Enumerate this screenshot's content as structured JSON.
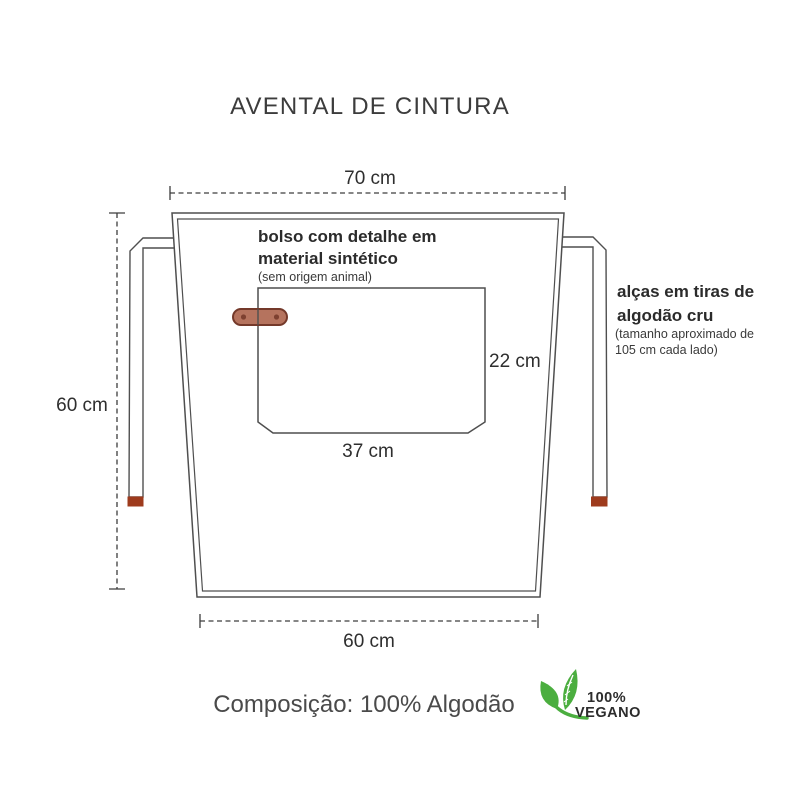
{
  "title": "AVENTAL DE CINTURA",
  "dimensions": {
    "top_width": "70 cm",
    "side_height": "60 cm",
    "bottom_width": "60 cm"
  },
  "pocket": {
    "height": "22 cm",
    "width": "37 cm",
    "note_line1": "bolso com detalhe em",
    "note_line2": "material sintético",
    "note_sub": "(sem origem animal)"
  },
  "straps": {
    "note_line1": "alças em tiras de",
    "note_line2": "algodão cru",
    "note_sub1": "(tamanho aproximado de",
    "note_sub2": "105 cm cada lado)"
  },
  "footer": {
    "composition": "Composição: 100% Algodão",
    "vegan_line1": "100%",
    "vegan_line2": "VEGANO"
  },
  "icons": {
    "vegan_leaves": "leaves-icon"
  },
  "colors": {
    "outline_gray": "#4f4f4f",
    "dimension_gray": "#3d3d3d",
    "text_dark": "#3a3a3a",
    "tag_fill": "#b5735e",
    "tag_border": "#74392a",
    "tag_rivet": "#7d4030",
    "strap_tip_rust": "#9e3b1d",
    "vegan_green": "#4bae3f"
  }
}
